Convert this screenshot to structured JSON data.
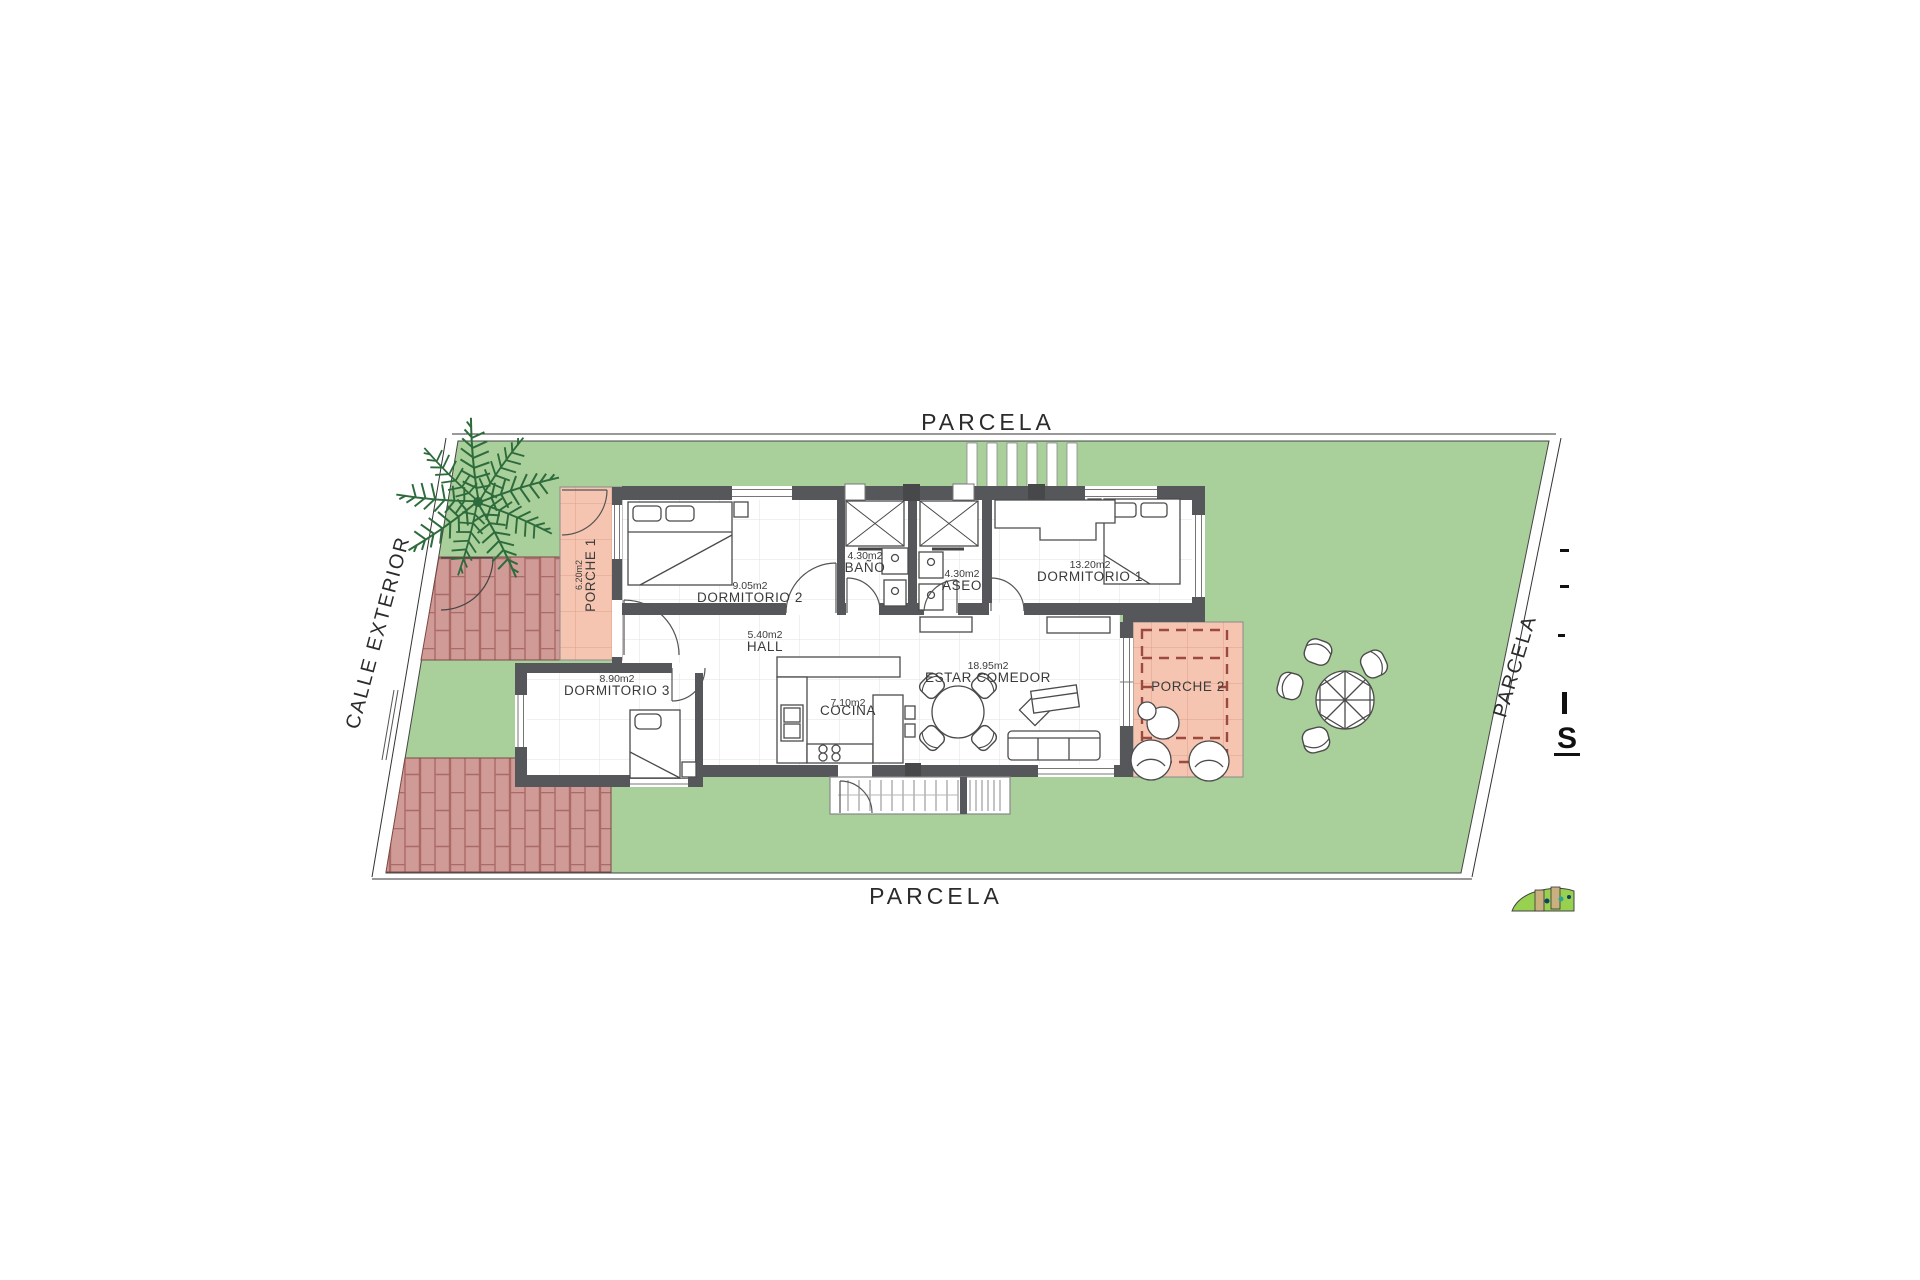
{
  "site": {
    "parcela_top": "PARCELA",
    "parcela_bottom": "PARCELA",
    "parcela_right": "PARCELA",
    "calle_exterior": "CALLE EXTERIOR"
  },
  "rooms": {
    "porche1": {
      "name": "PORCHE 1",
      "area": "6.20m2"
    },
    "dormitorio2": {
      "name": "DORMITORIO 2",
      "area": "9.05m2"
    },
    "bano": {
      "name": "BAÑO",
      "area": "4.30m2"
    },
    "aseo": {
      "name": "ASEO",
      "area": "4.30m2"
    },
    "dormitorio1": {
      "name": "DORMITORIO 1",
      "area": "13.20m2"
    },
    "hall": {
      "name": "HALL",
      "area": "5.40m2"
    },
    "dormitorio3": {
      "name": "DORMITORIO 3",
      "area": "8.90m2"
    },
    "cocina": {
      "name": "COCINA",
      "area": "7.10m2"
    },
    "estar": {
      "name": "ESTAR COMEDOR",
      "area": "18.95m2"
    },
    "porche2": {
      "name": "PORCHE 2"
    }
  },
  "edge_fragments": {
    "s": "S"
  },
  "colors": {
    "grass": "#a9cf9b",
    "porch_salmon": "#f6c5b1",
    "brick_fill": "#d09b96",
    "brick_line": "#aa6a65",
    "wall_gray": "#56575a",
    "palm_green": "#2e6b3c",
    "logo_green": "#98d14f",
    "tile_line": "#e0e0e0"
  }
}
